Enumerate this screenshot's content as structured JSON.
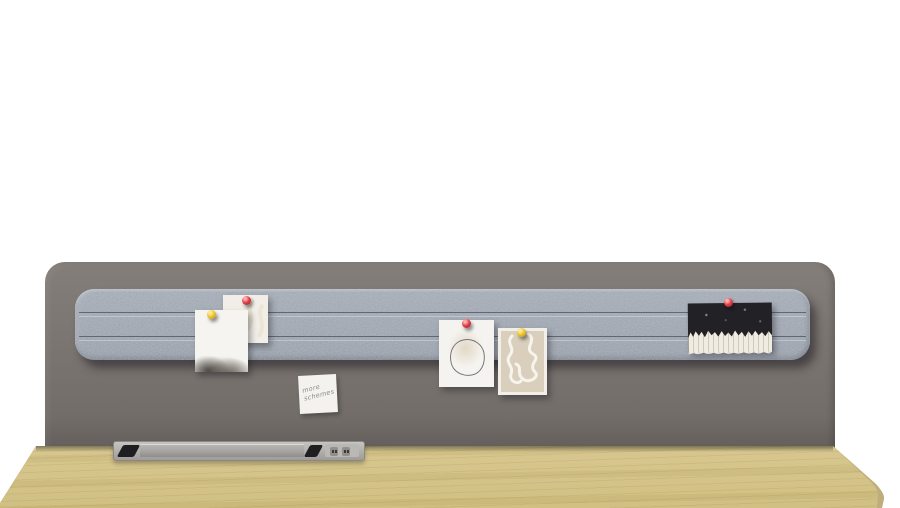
{
  "scene": {
    "description": "Product render: desk privacy panel with felt pin rail, pinned papers and notes, above a wooden desktop with a recessed cable and power module",
    "background_color": "#ffffff"
  },
  "colors": {
    "panel-top": "#847e7a",
    "panel-bottom": "#6e6965",
    "felt": "#98a0aa",
    "felt-dark": "#8d959f",
    "groove": "#5d6570",
    "wood-light": "#e9e0bc",
    "wood-edge": "#c0ad7e",
    "pin-red": "#e13c49",
    "pin-red-dark": "#9e1f2c",
    "pin-yellow": "#eec52f",
    "pin-yellow-dark": "#b98f14",
    "card-black": "#222126",
    "paper-white": "#f5f3ef",
    "art-beige": "#d9cfbc",
    "module-lid": "#a5a3a0",
    "module-frame": "#c6c4c1"
  },
  "sticky_note": {
    "line1": "more",
    "line2": "schemes"
  },
  "pins": {
    "left_group_back": "red",
    "left_group_front": "yellow",
    "center_left_paper": "red",
    "center_right_paper": "yellow",
    "right_card": "red"
  }
}
